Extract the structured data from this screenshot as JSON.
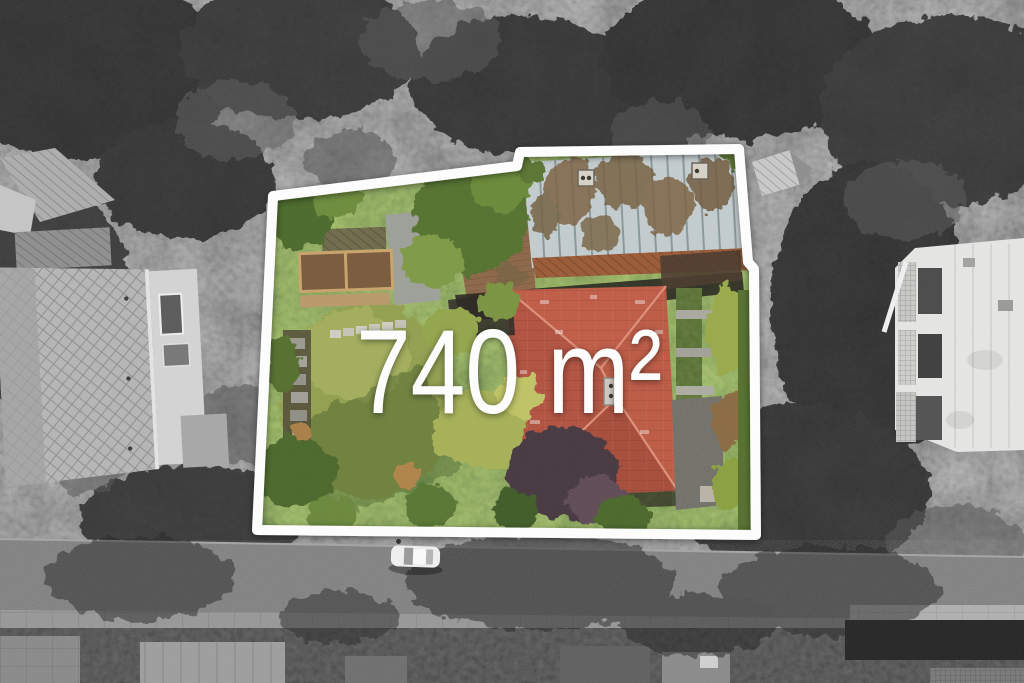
{
  "overlay": {
    "area_label": "740 m²"
  },
  "legend": {
    "highlight_style": "colour photo inside plot outline, grayscale outside",
    "boundary_color": "#ffffff",
    "text_color": "#ffffff"
  },
  "palette": {
    "red_hip_roof": "#b5523f",
    "weathered_flat_roof": "#c3ccce",
    "barn_tile_roof": "#8d6748",
    "lawn_green": "#93a050",
    "foliage_green": "#55722e",
    "autumn_tree": "#a7b156",
    "purple_leaf_tree": "#463841",
    "street_gray": "#7f7f7f",
    "surroundings": "grayscale"
  },
  "scene": {
    "kind": "aerial-drone-photo",
    "subject": "residential plot of 740 m² highlighted with a white boundary outline",
    "objects": [
      "plot-outline",
      "area-label",
      "red-hip-roof-house",
      "flat-roof-outbuilding",
      "barn-tile-roof",
      "garden-lawn",
      "raised-beds",
      "stepping-stone-path",
      "hedge-and-path-strip",
      "neighbor-house-left",
      "neighbor-building-right",
      "street",
      "sidewalk",
      "parked-white-car",
      "tree-canopy"
    ]
  }
}
